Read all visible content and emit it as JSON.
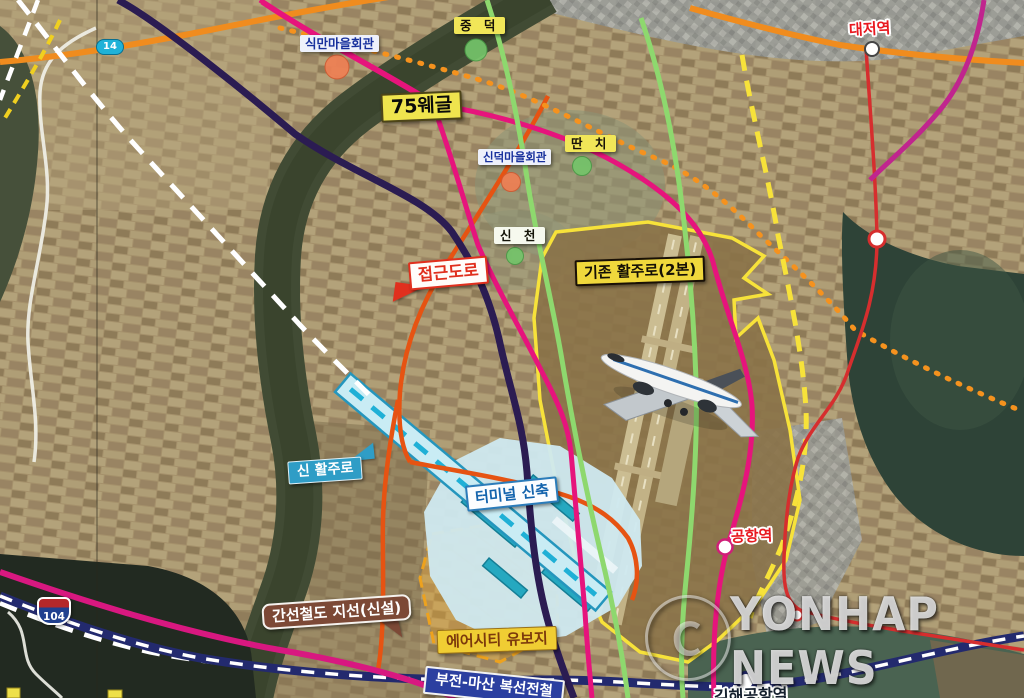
{
  "watermark": {
    "copyright_symbol": "ⓒ",
    "agency": "YONHAP NEWS"
  },
  "route_shields": {
    "route_14": "14",
    "route_104": "104"
  },
  "places": {
    "sikman_hall": "식만마을회관",
    "jungdeok": "중 덕",
    "marker_75": "75웨글",
    "sindeok_hall": "신덕마을회관",
    "ttanchi": "딴 치",
    "sincheon": "신 천"
  },
  "plan_labels": {
    "access_road": "접근도로",
    "existing_runway": "기존 활주로(2본)",
    "new_runway": "신 활주로",
    "new_terminal": "터미널 신축",
    "rail_branch": "간선철도 지선(신설)",
    "aircity_reserve": "에어시티 유보지"
  },
  "stations": {
    "airport_station": "공항역",
    "daejeo_station": "대저역",
    "gimhae_airport_station": "김해공항역"
  },
  "rail_line_label": {
    "bujeon_masan": "부전-마산 복선전철"
  },
  "colors": {
    "light_rail_pink": "#e6147c",
    "metro_navy": "#2b1c52",
    "commuter_rail_navy": "#232a6e",
    "road_orange": "#f08c1e",
    "line_green": "#8ed86e",
    "line_red": "#d62e2e",
    "boundary_yellow": "#f7e23a",
    "plan_red_orange": "#e65312",
    "new_runway_cyan": "#29b6d6",
    "aircity_gold": "#eda21e",
    "station_text_red": "#e8191f"
  }
}
